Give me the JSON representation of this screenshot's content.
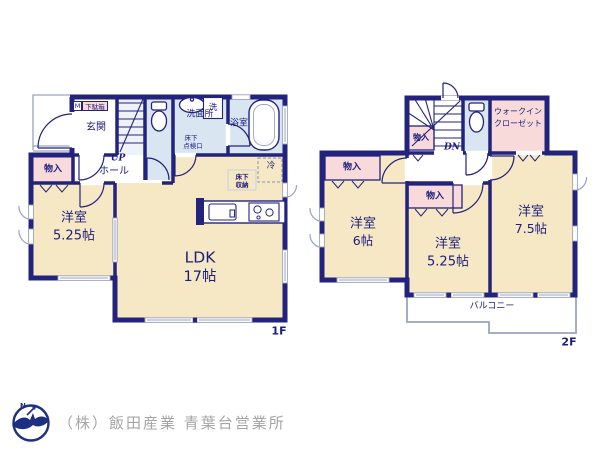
{
  "floor1": {
    "floor_label": "1F",
    "entrance": "玄関",
    "shoe_m": "M",
    "shoe_box": "下駄箱",
    "closet": "物入",
    "up": "UP",
    "hall": "ホール",
    "washroom": "洗面所",
    "washer": "洗",
    "hatch_line1": "床下",
    "hatch_line2": "点検口",
    "bathroom": "浴室",
    "fridge": "冷",
    "storage_line1": "床下",
    "storage_line2": "収納",
    "room1_name": "洋室",
    "room1_size": "5.25帖",
    "ldk_name": "LDK",
    "ldk_size": "17帖"
  },
  "floor2": {
    "floor_label": "2F",
    "dn": "DN",
    "closet_stair": "物入",
    "wic_line1": "ウォークイン",
    "wic_line2": "クローゼット",
    "closet_left": "物入",
    "closet_mid": "物入",
    "room6_name": "洋室",
    "room6_size": "6帖",
    "room525_name": "洋室",
    "room525_size": "5.25帖",
    "room75_name": "洋室",
    "room75_size": "7.5帖",
    "balcony": "バルコニー"
  },
  "footer": {
    "logo_n": "N",
    "company": "（株）飯田産業 青葉台営業所"
  },
  "colors": {
    "wall_navy": "#23237d",
    "room_cream": "#f6e8c5",
    "closet_pink": "#f9dadb",
    "wet_area_blue": "#d9e6f2",
    "text_navy": "#1d1d7d",
    "window_gray": "#9aa3c0",
    "footer_text_gray": "#a5a5a5",
    "logo_navy": "#1d2f80"
  }
}
